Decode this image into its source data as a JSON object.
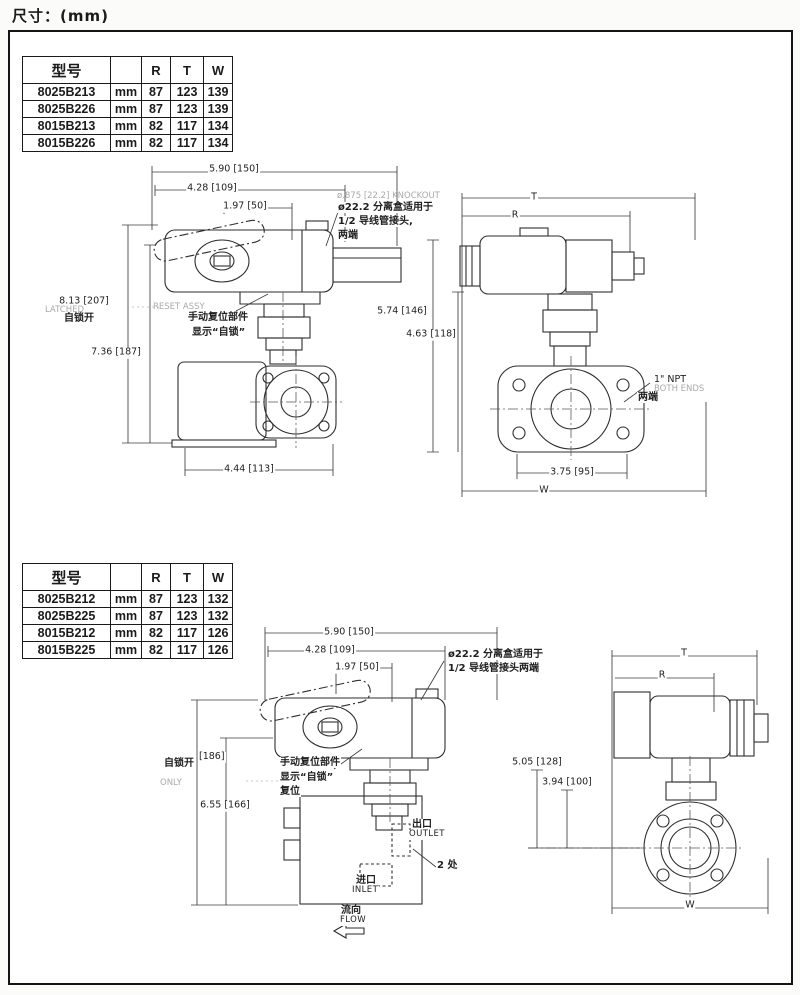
{
  "page": {
    "title": "尺寸：(mm)"
  },
  "tables": {
    "top": {
      "headers": [
        "型号",
        "",
        "R",
        "T",
        "W"
      ],
      "rows": [
        [
          "8025B213",
          "mm",
          "87",
          "123",
          "139"
        ],
        [
          "8025B226",
          "mm",
          "87",
          "123",
          "139"
        ],
        [
          "8015B213",
          "mm",
          "82",
          "117",
          "134"
        ],
        [
          "8015B226",
          "mm",
          "82",
          "117",
          "134"
        ]
      ]
    },
    "bottom": {
      "headers": [
        "型号",
        "",
        "R",
        "T",
        "W"
      ],
      "rows": [
        [
          "8025B212",
          "mm",
          "87",
          "123",
          "132"
        ],
        [
          "8025B225",
          "mm",
          "87",
          "123",
          "132"
        ],
        [
          "8015B212",
          "mm",
          "82",
          "117",
          "126"
        ],
        [
          "8015B225",
          "mm",
          "82",
          "117",
          "126"
        ]
      ]
    }
  },
  "drawing_top_left": {
    "dim_590": "5.90 [150]",
    "dim_428": "4.28 [109]",
    "dim_197": "1.97 [50]",
    "dim_813": "8.13 [207]",
    "dim_736": "7.36 [187]",
    "dim_444": "4.44 [113]",
    "latched_en": "LATCHED",
    "latched_cn": "自锁开",
    "reset_en": "RESET ASSY",
    "reset_cn_1": "手动复位部件",
    "reset_cn_2": "显示“自锁”",
    "knockout_en": "ø.875 [22.2] KNOCKOUT",
    "knockout_cn_1": "ø22.2 分离盒适用于",
    "knockout_cn_2": "1/2 导线管接头,",
    "knockout_cn_3": "两端"
  },
  "drawing_top_right": {
    "dim_t": "T",
    "dim_r": "R",
    "dim_w": "W",
    "dim_574": "5.74 [146]",
    "dim_463": "4.63 [118]",
    "dim_375": "3.75 [95]",
    "npt_en_1": "1\" NPT",
    "npt_en_2": "BOTH ENDS",
    "npt_cn": "两端"
  },
  "drawing_bottom_left": {
    "dim_590": "5.90 [150]",
    "dim_428": "4.28 [109]",
    "dim_197": "1.97 [50]",
    "dim_186": "[186]",
    "dim_655": "6.55 [166]",
    "latched_cn": "自锁开",
    "only_en": "ONLY",
    "reset_cn_1": "手动复位部件",
    "reset_cn_2": "显示“自锁”",
    "reset_cn_3": "复位",
    "knockout_cn_1": "ø22.2 分离盒适用于",
    "knockout_cn_2": "1/2 导线管接头两端",
    "outlet_cn": "出口",
    "outlet_en": "OUTLET",
    "ports_note": "2 处",
    "inlet_cn": "进口",
    "inlet_en": "INLET",
    "flow_cn": "流向",
    "flow_en": "FLOW"
  },
  "drawing_bottom_right": {
    "dim_t": "T",
    "dim_r": "R",
    "dim_w": "W",
    "dim_505": "5.05 [128]",
    "dim_394": "3.94 [100]"
  }
}
